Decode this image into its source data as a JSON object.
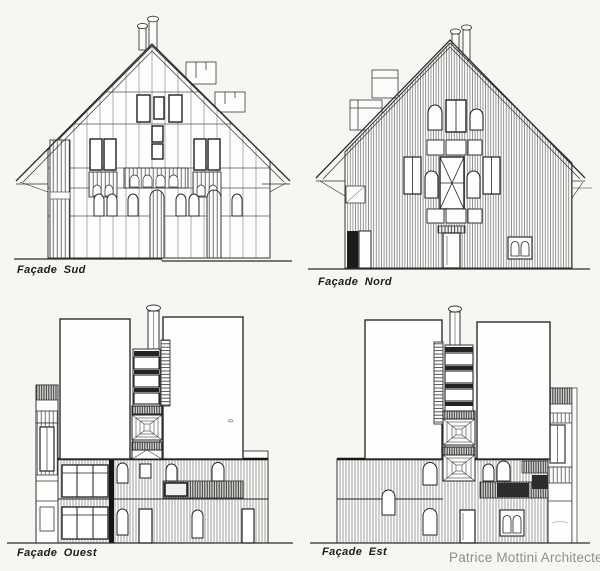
{
  "sheet": {
    "background": "#f7f6f3",
    "ink": "#2d2d2d"
  },
  "facades": {
    "sud": {
      "label": "Façade Sud"
    },
    "nord": {
      "label": "Façade Nord"
    },
    "ouest": {
      "label": "Façade Ouest"
    },
    "est": {
      "label": "Façade Est"
    }
  },
  "attribution": {
    "text": "Patrice Mottini Architecte",
    "color": "#8f8f8f"
  }
}
